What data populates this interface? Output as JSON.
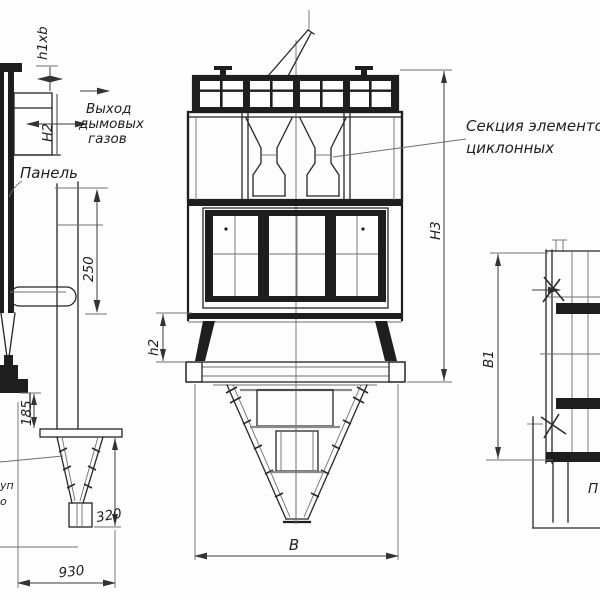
{
  "annotations": {
    "gas_outlet": {
      "line1": "Выход",
      "line2": "дымовых",
      "line3": "газов"
    },
    "panel_label": "Панель",
    "cyclone_section": {
      "line1": "Секция элементов",
      "line2": "циклонных"
    },
    "fragments": {
      "left_top": "уп",
      "left_bottom": "о",
      "bottom_right": "П"
    }
  },
  "dimensions": {
    "outlet_section": "h1xb",
    "outlet_height": "Н2",
    "panel_offset": "250",
    "discharge_height": "185",
    "hopper_box_height": "320",
    "base_width": "930",
    "support_height": "h2",
    "overall_height": "Н3",
    "body_width": "В",
    "body_depth": "В1"
  },
  "colors": {
    "line": "#262626",
    "line_light": "#6e6e6e",
    "background": "#ffffff"
  }
}
